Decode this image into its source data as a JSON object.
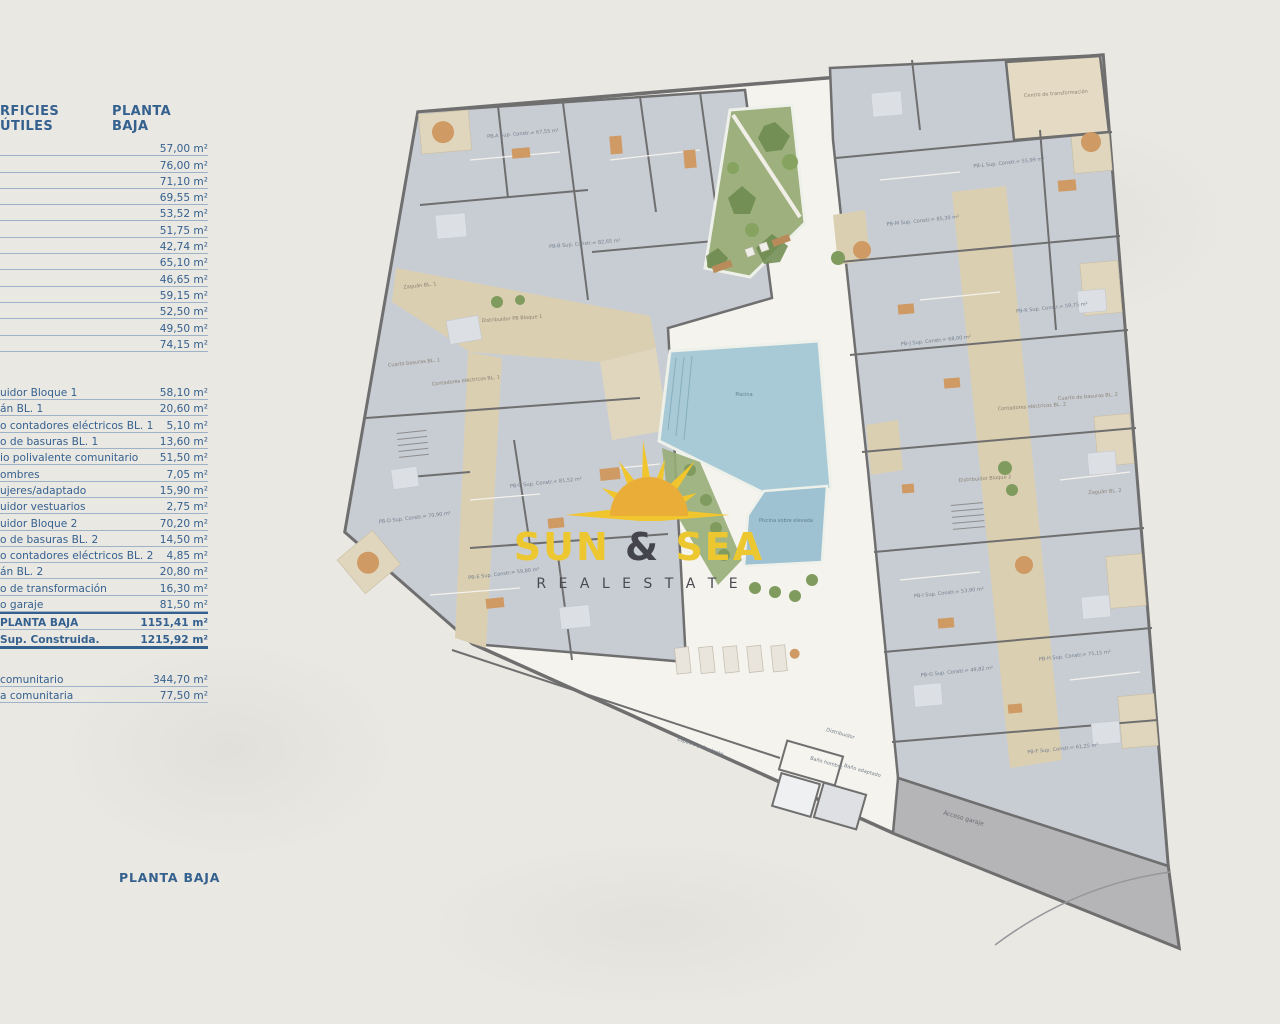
{
  "page": {
    "bottom_title": "PLANTA BAJA"
  },
  "table": {
    "header": {
      "left": "RFICIES ÚTILES",
      "right": "PLANTA BAJA"
    },
    "apartment_rows": [
      {
        "label": "",
        "value": "57,00 m²"
      },
      {
        "label": "",
        "value": "76,00 m²"
      },
      {
        "label": "",
        "value": "71,10 m²"
      },
      {
        "label": "",
        "value": "69,55 m²"
      },
      {
        "label": "",
        "value": "53,52 m²"
      },
      {
        "label": "",
        "value": "51,75 m²"
      },
      {
        "label": "",
        "value": "42,74 m²"
      },
      {
        "label": "",
        "value": "65,10 m²"
      },
      {
        "label": "",
        "value": "46,65 m²"
      },
      {
        "label": "",
        "value": "59,15 m²"
      },
      {
        "label": "",
        "value": "52,50 m²"
      },
      {
        "label": "",
        "value": "49,50 m²"
      },
      {
        "label": "",
        "value": "74,15 m²"
      }
    ],
    "common_rows": [
      {
        "label": "uidor Bloque 1",
        "value": "58,10 m²"
      },
      {
        "label": "án BL. 1",
        "value": "20,60 m²"
      },
      {
        "label": "o contadores eléctricos BL. 1",
        "value": "5,10 m²"
      },
      {
        "label": "o de basuras BL. 1",
        "value": "13,60 m²"
      },
      {
        "label": "io polivalente comunitario",
        "value": "51,50 m²"
      },
      {
        "label": "ombres",
        "value": "7,05 m²"
      },
      {
        "label": "ujeres/adaptado",
        "value": "15,90 m²"
      },
      {
        "label": "uidor vestuarios",
        "value": "2,75 m²"
      },
      {
        "label": "uidor Bloque 2",
        "value": "70,20 m²"
      },
      {
        "label": "o de basuras BL. 2",
        "value": "14,50 m²"
      },
      {
        "label": "o contadores eléctricos BL. 2",
        "value": "4,85 m²"
      },
      {
        "label": "án BL. 2",
        "value": "20,80 m²"
      },
      {
        "label": "o de transformación",
        "value": "16,30 m²"
      },
      {
        "label": "o garaje",
        "value": "81,50 m²"
      }
    ],
    "total_rows": [
      {
        "label": "PLANTA BAJA",
        "value": "1151,41 m²"
      },
      {
        "label": "Sup. Construida.",
        "value": "1215,92 m²"
      }
    ],
    "extra_rows": [
      {
        "label": "comunitario",
        "value": "344,70 m²"
      },
      {
        "label": "a comunitaria",
        "value": "77,50 m²"
      }
    ]
  },
  "logo": {
    "sun": "SUN",
    "amp": " & ",
    "sea": "SEA",
    "tagline": "R E A L   E S T A T E"
  },
  "plan": {
    "apartments": [
      "PB-A Sup. Constr.= 67,55 m²",
      "PB-B Sup. Constr.= 82,65 m²",
      "PB-C Sup. Constr.= 81,52 m²",
      "PB-D Sup. Constr.= 70,90 m²",
      "PB-E Sup. Constr.= 59,80 m²",
      "PB-F Sup. Constr.= 61,25 m²",
      "PB-G Sup. Constr.= 49,82 m²",
      "PB-H Sup. Constr.= 75,15 m²",
      "PB-I Sup. Constr.= 53,90 m²",
      "PB-J Sup. Constr.= 68,00 m²",
      "PB-K Sup. Constr.= 59,75 m²",
      "PB-L Sup. Constr.= 55,99 m²",
      "PB-M Sup. Constr.= 85,30 m²"
    ],
    "labels": {
      "piscina": "Piscina",
      "piscina_elevada": "Piscina sobre elevada",
      "espacio_polivalente": "Espacio polivalente",
      "acceso_garaje": "Acceso garaje",
      "distribuidor": "Distribuidor",
      "bano_hombre": "Baño hombre",
      "bano_adaptado": "Baño adaptado",
      "zaguan_bl1": "Zaguán BL. 1",
      "distribuidor_bl1": "Distribuidor PB Bloque 1",
      "basuras_bl1": "Cuarto basuras BL. 1",
      "contadores_bl1": "Contadores eléctricos BL. 1",
      "centro_transformacion": "Centro de transformación",
      "basuras_bl2": "Cuarto de basuras BL. 2",
      "contadores_bl2": "Contadores eléctricos BL. 2",
      "distribuidor_bl2": "Distribuidor Bloque 2",
      "zaguan_bl2": "Zaguán BL. 2"
    }
  },
  "colors": {
    "table_text": "#35618f",
    "logo_yellow": "#edc730",
    "logo_dark": "#44444c",
    "wall_gray": "#6f6f6f",
    "apartment_fill": "#c8cdd4",
    "communal_tan": "#dbcfb2",
    "pool_blue": "#a8cad6",
    "garden_green": "#9db07e",
    "ramp_gray": "#b5b5b8"
  }
}
